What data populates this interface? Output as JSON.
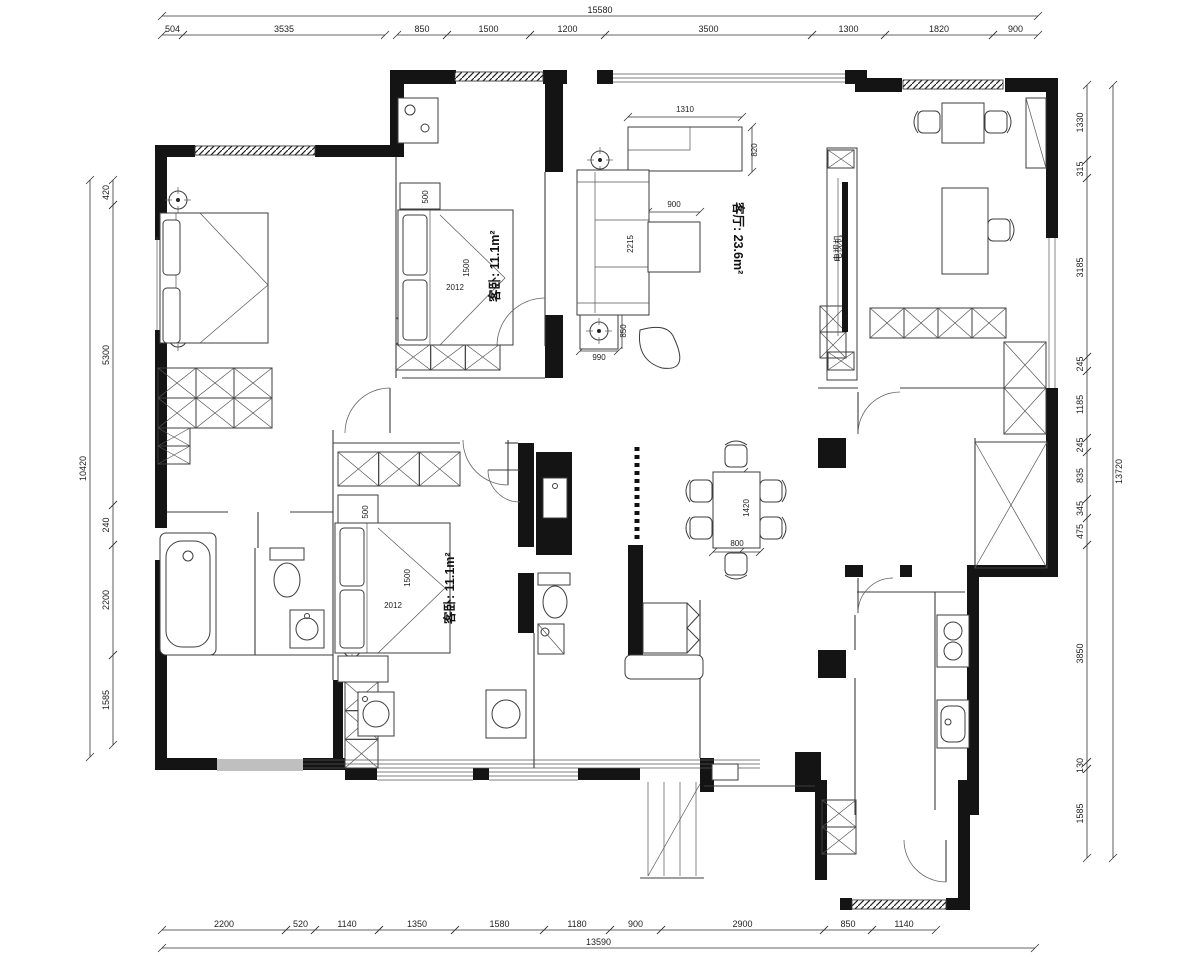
{
  "plan": {
    "living_label": "客厅: 23.6m²",
    "bedroom_top_label": "客卧: 11.1m²",
    "bedroom_mid_label": "客卧: 11.1m²",
    "tv_label": "电视机"
  },
  "dims": {
    "top_total": "15580",
    "top": [
      "504",
      "3535",
      "850",
      "1500",
      "1200",
      "3500",
      "1300",
      "1820",
      "900"
    ],
    "bottom_total": "13590",
    "bottom": [
      "2200",
      "520",
      "1140",
      "1350",
      "1580",
      "1180",
      "900",
      "2900",
      "850",
      "1140"
    ],
    "left_total": "10420",
    "left": [
      "420",
      "5300",
      "240",
      "2200",
      "1585"
    ],
    "right_total": "13720",
    "right": [
      "1330",
      "315",
      "3185",
      "245",
      "1185",
      "245",
      "835",
      "345",
      "475",
      "3850",
      "130",
      "1585"
    ]
  },
  "furniture": {
    "tv_cabinet_w": "1310",
    "tv_cabinet_d": "820",
    "coffee_w": "900",
    "sofa_l": "2215",
    "fan_w": "990",
    "fan_d": "850",
    "dining_l": "1420",
    "dining_w": "800",
    "bed1_w": "1500",
    "bed1_l": "2012",
    "bed2_w": "1500",
    "bed2_l": "2012",
    "ns1": "500",
    "ns2": "500"
  },
  "colors": {
    "wall": "#141414",
    "line": "#3c3c3c",
    "bg": "#ffffff"
  }
}
